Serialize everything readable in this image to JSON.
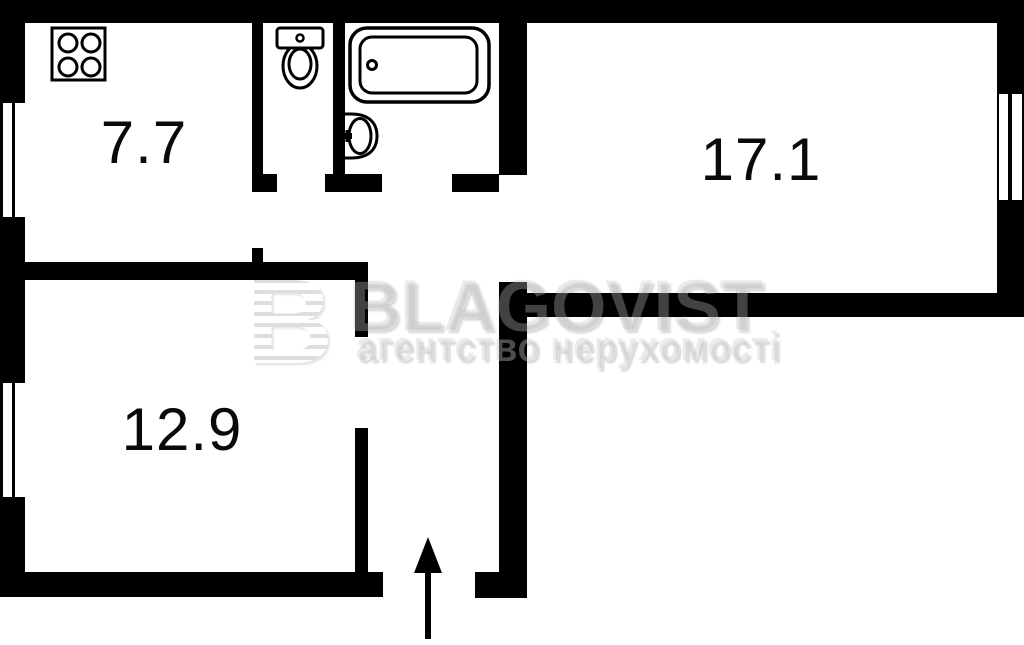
{
  "document": {
    "type": "apartment-floor-plan"
  },
  "rooms": [
    {
      "name": "kitchen",
      "area_label": "7.7"
    },
    {
      "name": "living-room",
      "area_label": "17.1"
    },
    {
      "name": "bedroom",
      "area_label": "12.9"
    }
  ],
  "fixtures": [
    "stove",
    "toilet",
    "bathtub",
    "sink"
  ],
  "entrance": {
    "direction": "up"
  },
  "watermark": {
    "logo_letter": "B",
    "brand": "BLAGOVIST",
    "tagline": "агентство нерухомості"
  },
  "colors": {
    "walls": "#000000",
    "background": "#ffffff",
    "labels": "#0a0a0a"
  }
}
